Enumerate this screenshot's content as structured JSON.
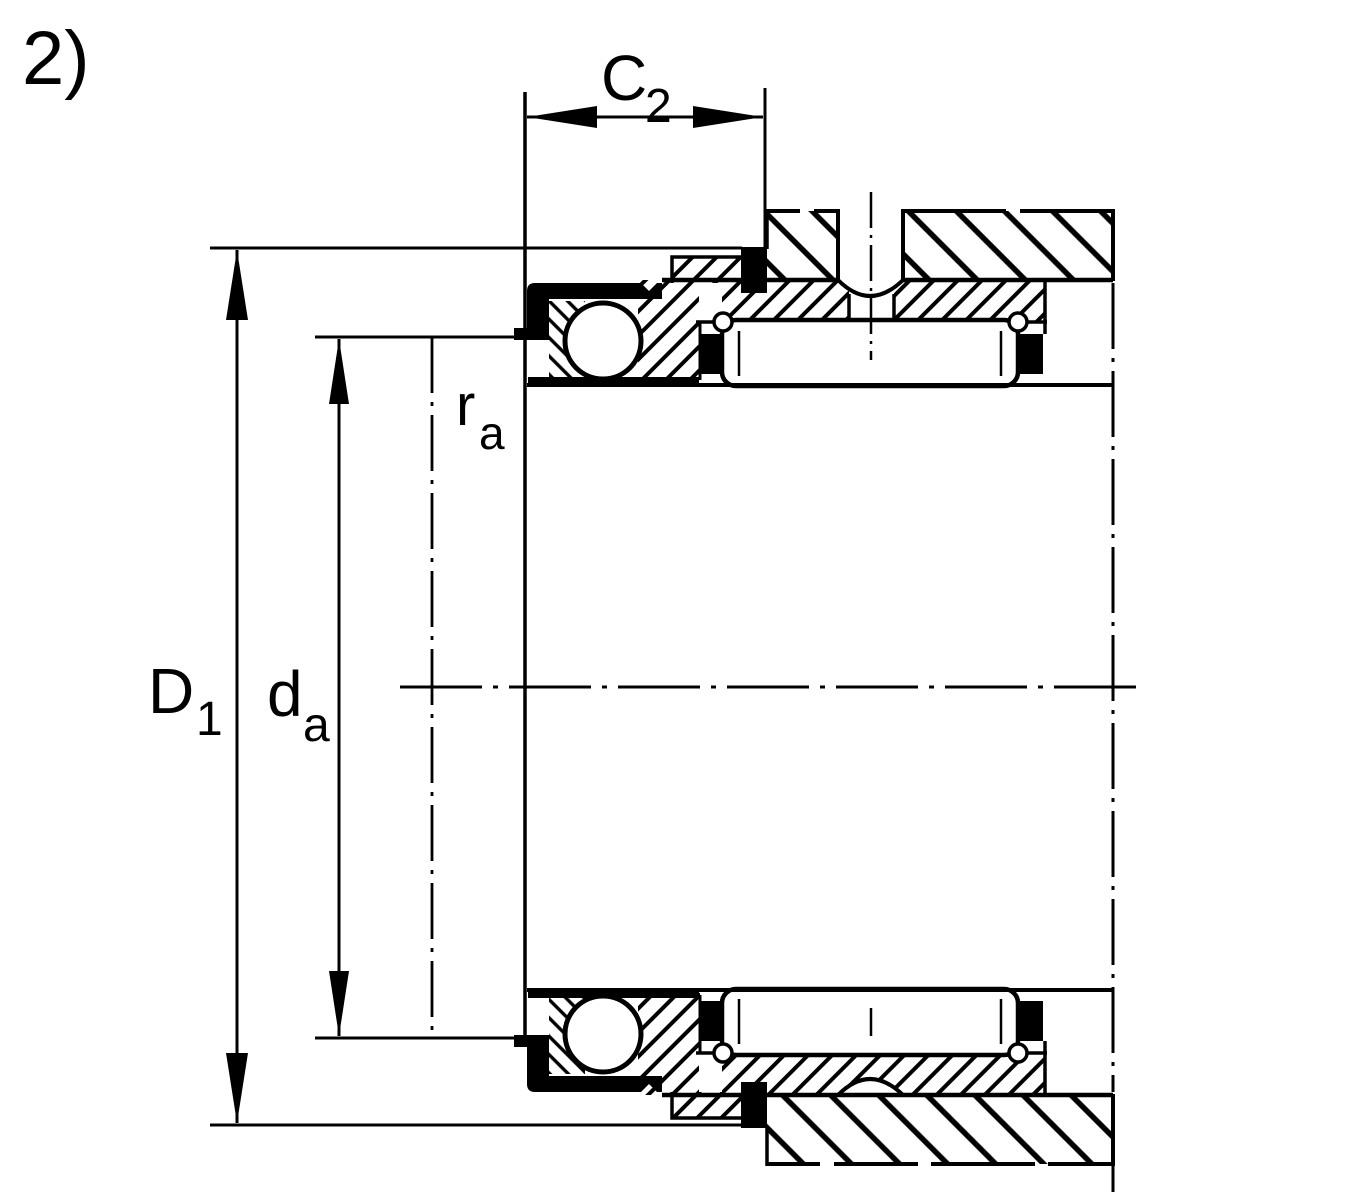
{
  "figure": {
    "label": "2)"
  },
  "dimension_labels": {
    "c2": {
      "base": "C",
      "sub": "2"
    },
    "d1": {
      "base": "D",
      "sub": "1"
    },
    "da": {
      "base": "d",
      "sub": "a"
    },
    "ra": {
      "base": "r",
      "sub": "a"
    }
  },
  "colors": {
    "line": "#000000",
    "background": "#ffffff"
  }
}
